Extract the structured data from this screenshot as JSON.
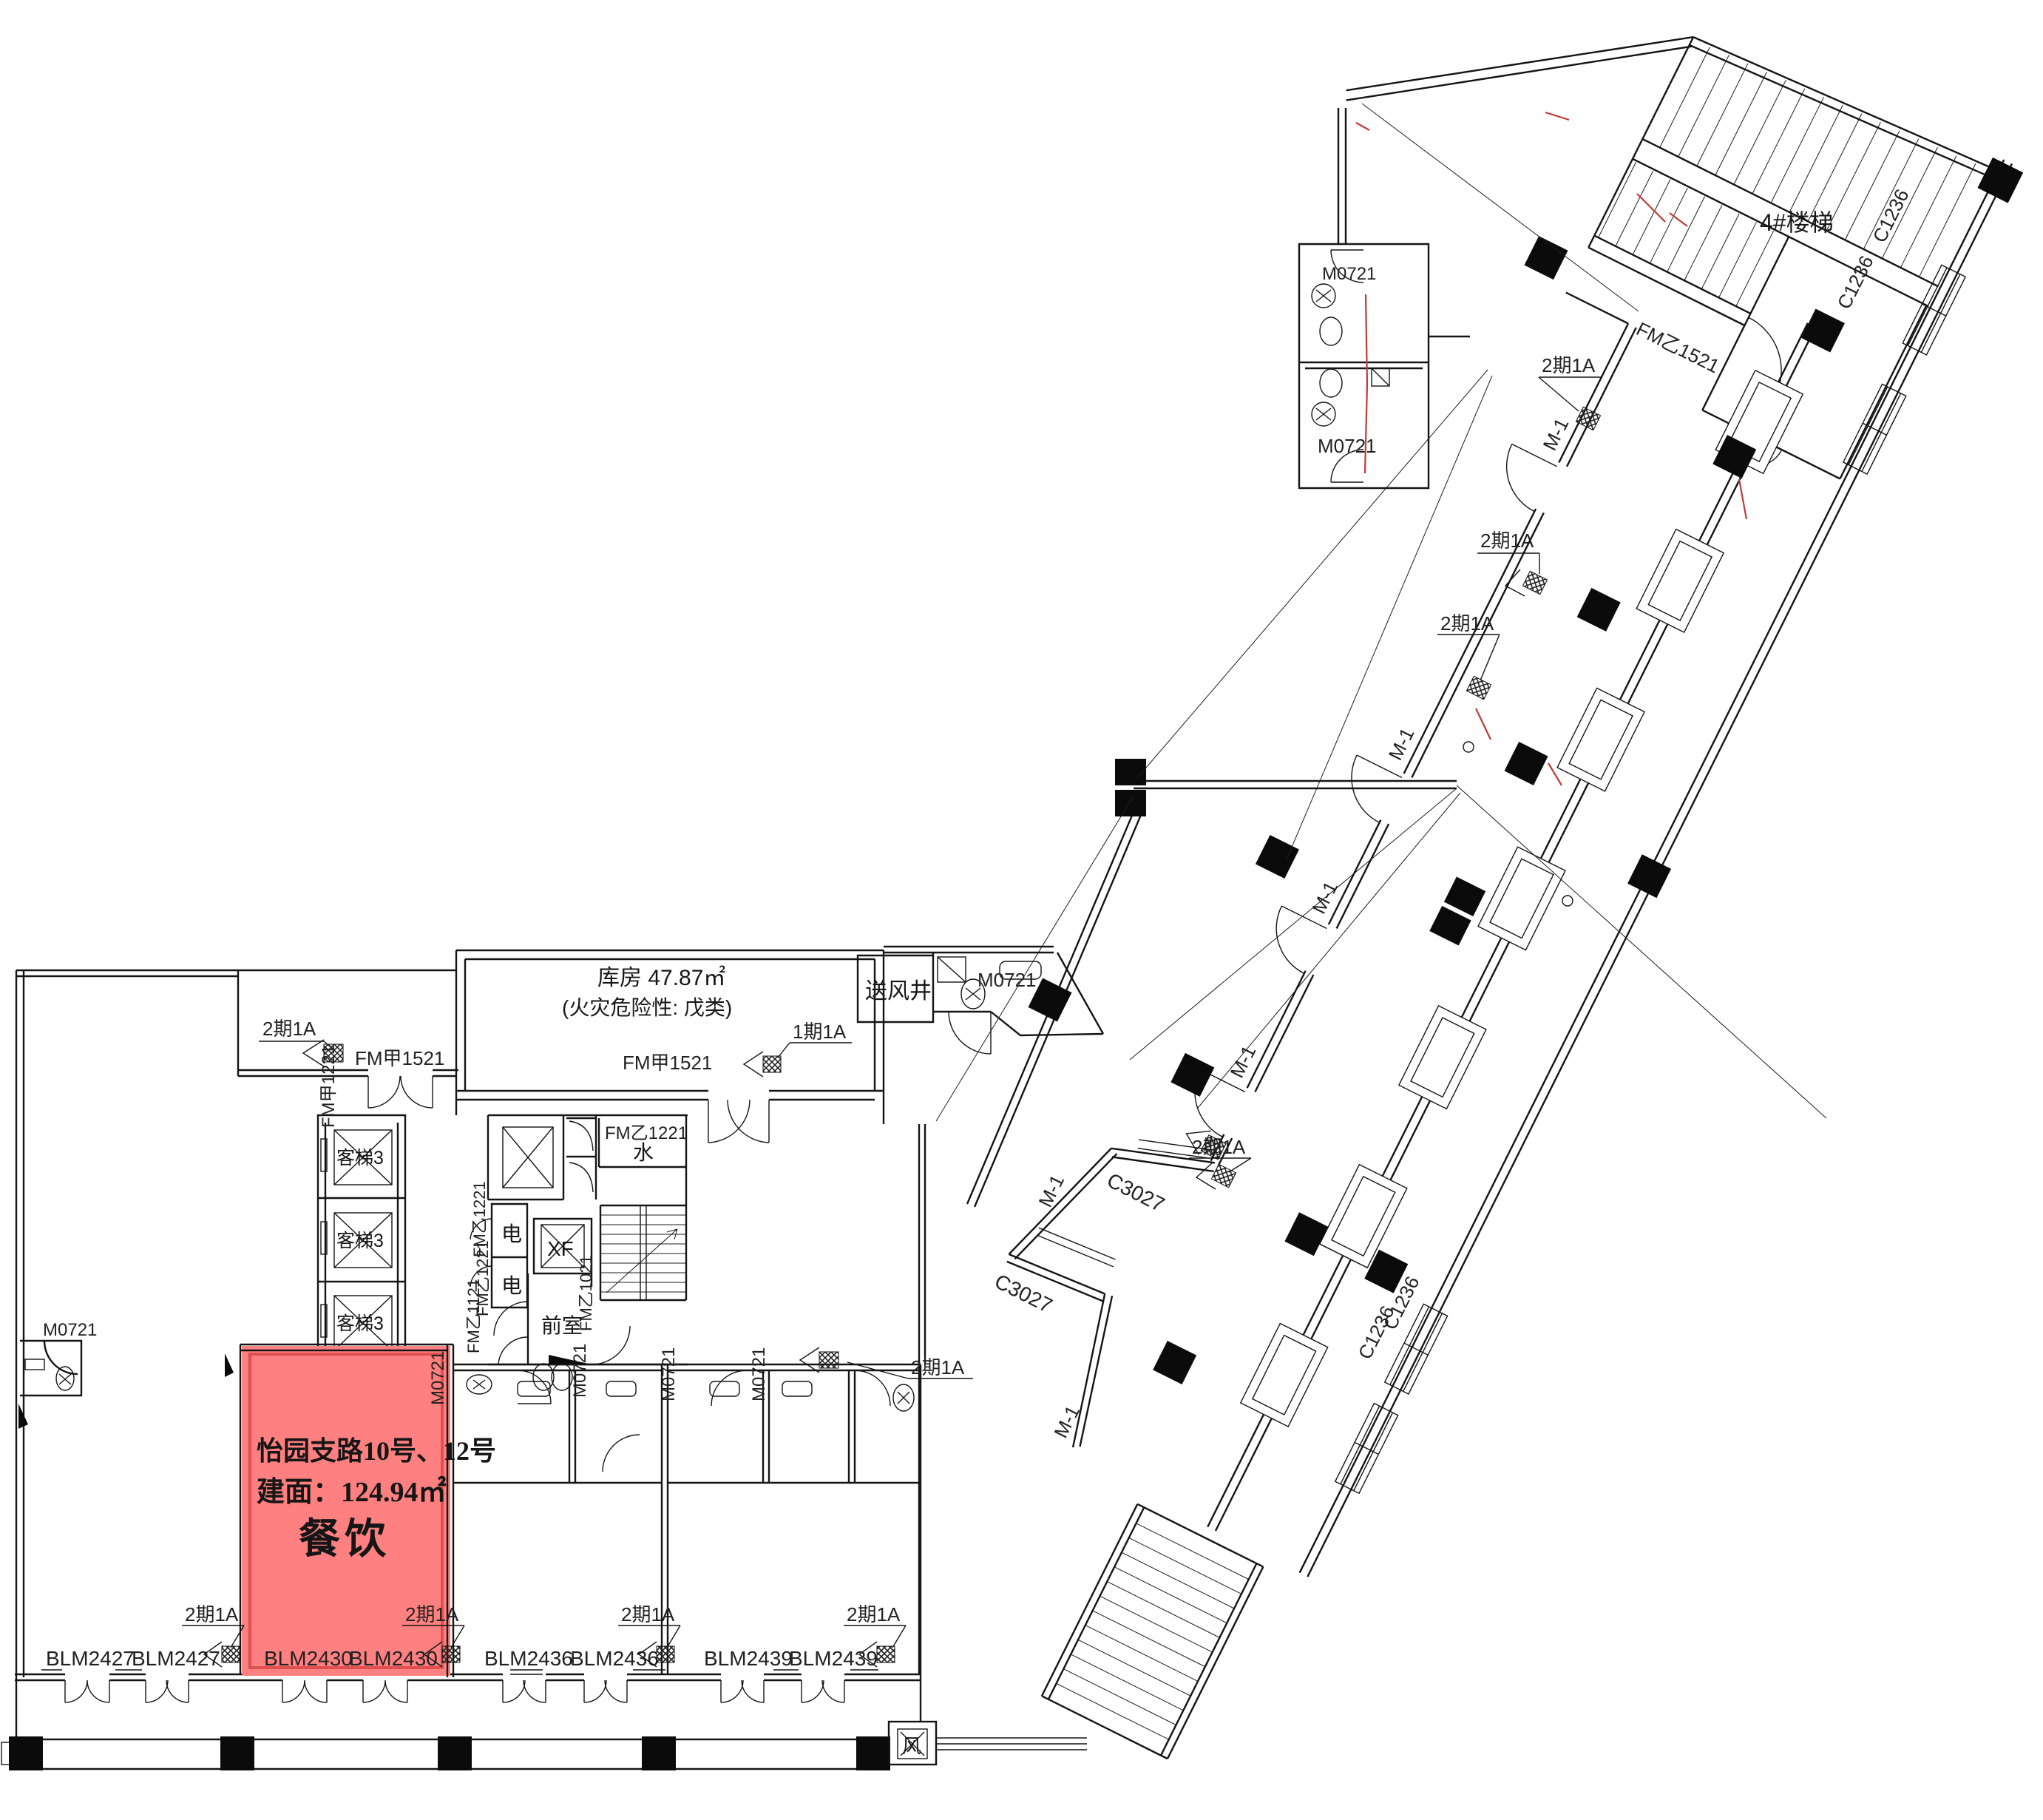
{
  "highlight": {
    "address": "怡园支路10号、12号",
    "area": "建面：124.94㎡",
    "use": "餐饮",
    "fill": "#FF8080",
    "stroke": "#E05050"
  },
  "rooms": {
    "storage": "库房  47.87㎡",
    "storage_note": "(火灾危险性: 戊类)",
    "lift": "客梯3",
    "water": "水",
    "elec": "电",
    "fire_lift": "XF",
    "front_room": "前室",
    "air_shaft": "送风井",
    "fan": "风",
    "stair4": "4#楼梯"
  },
  "doors": {
    "fm_jia_1521": "FM甲1521",
    "fm_jia_1221": "FM甲1221",
    "fm_yi_1221": "FM乙1221",
    "fm_yi_1121": "FM乙1121",
    "fm_yi_1021": "FM乙1021",
    "fm_yi_1521": "FM乙1521",
    "m0721": "M0721",
    "m1": "M-1",
    "phase2": "2期1A",
    "phase1": "1期1A"
  },
  "windows": {
    "c1236": "C1236",
    "c3027": "C3027"
  },
  "shops": {
    "blm2427": "BLM2427",
    "blm2430": "BLM2430",
    "blm2436": "BLM2436",
    "blm2439": "BLM2439"
  }
}
